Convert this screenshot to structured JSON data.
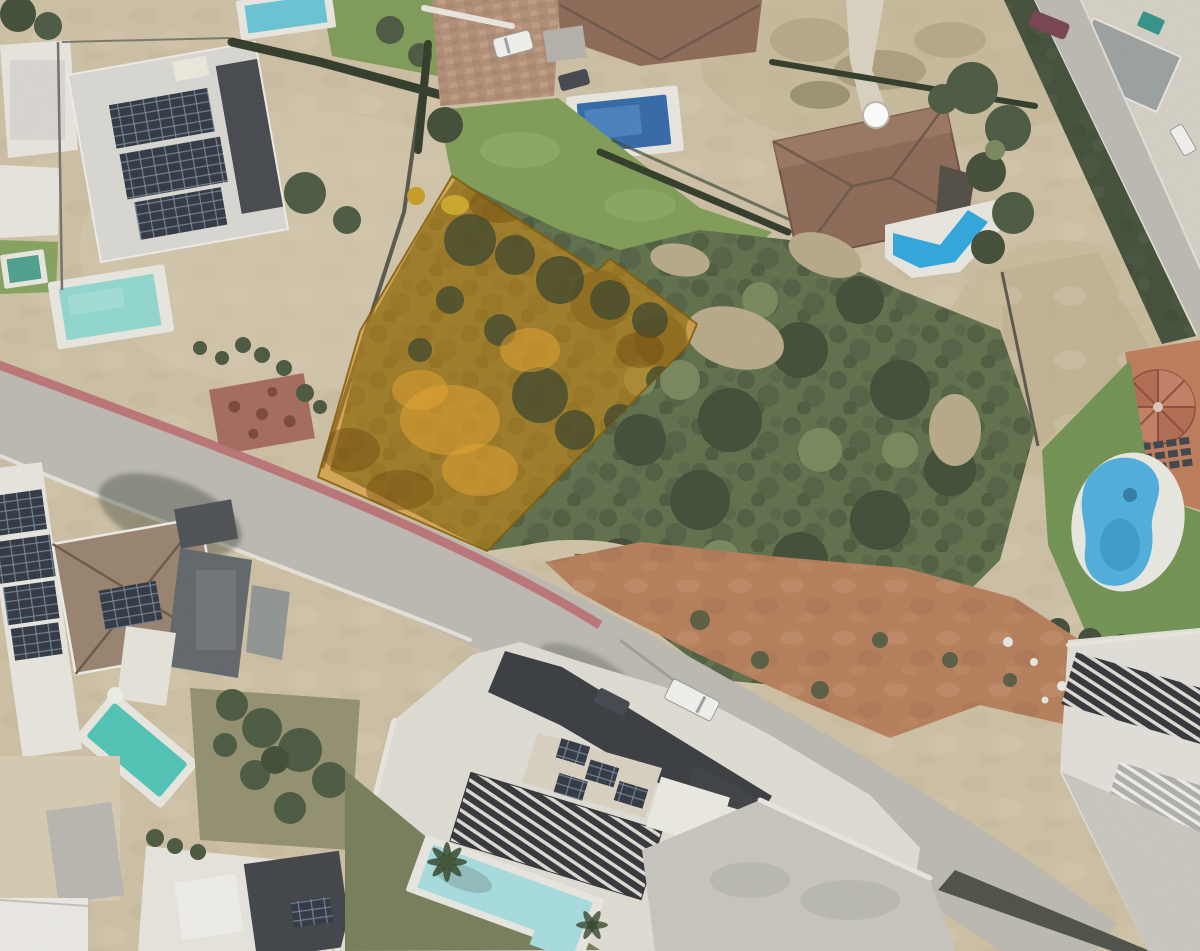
{
  "scene": {
    "kind": "aerial-satellite-photo",
    "subject": "Residential neighborhood seen from above with one vacant plot highlighted in translucent orange",
    "highlighted_plot": {
      "points": "452,176 597,271 610,259 697,324 688,345 487,551 318,477 360,331",
      "fill": "#dd8a00",
      "fill_opacity": 0.5,
      "stroke": "#7c5800"
    },
    "palette": {
      "ground_tan": "#cdc0a4",
      "road_asphalt": "#bcb9b2",
      "sidewalk_pink": "#b96a6e",
      "scrub_green": "#5c6d48",
      "lawn_green": "#7e9b54",
      "lawn_right": "#6f9150",
      "red_dirt": "#b57c58",
      "clay_court": "#bd7a58",
      "pool_pale": "#a5dde0",
      "pool_kidney": "#4aaede",
      "pool_blue": "#2ba6de",
      "pool_dark_blue": "#2f66a8",
      "pool_turquoise": "#4cc4b6",
      "pool_left": "#8fd8d0",
      "parcel_orange": "#dd8a00",
      "parcel_border": "#7c5800",
      "tree_dark": "#3f4c36",
      "roof_terracotta": "#8a6754",
      "roof_charcoal": "#35383d",
      "roof_light": "#d7d6d1",
      "solar_panel": "#2c3440",
      "building_white": "#e8e6e0"
    },
    "features": [
      "orange highlighted land parcel",
      "main road crossing diagonally",
      "side road at top right",
      "villas with terracotta roofs",
      "modern white villas",
      "rooftop solar panel arrays",
      "eight swimming pools including a kidney-shaped pool",
      "green scrubland with trees",
      "red dirt clearing",
      "white van and cars on the road",
      "satellite dish",
      "pergola slat roofs"
    ]
  }
}
